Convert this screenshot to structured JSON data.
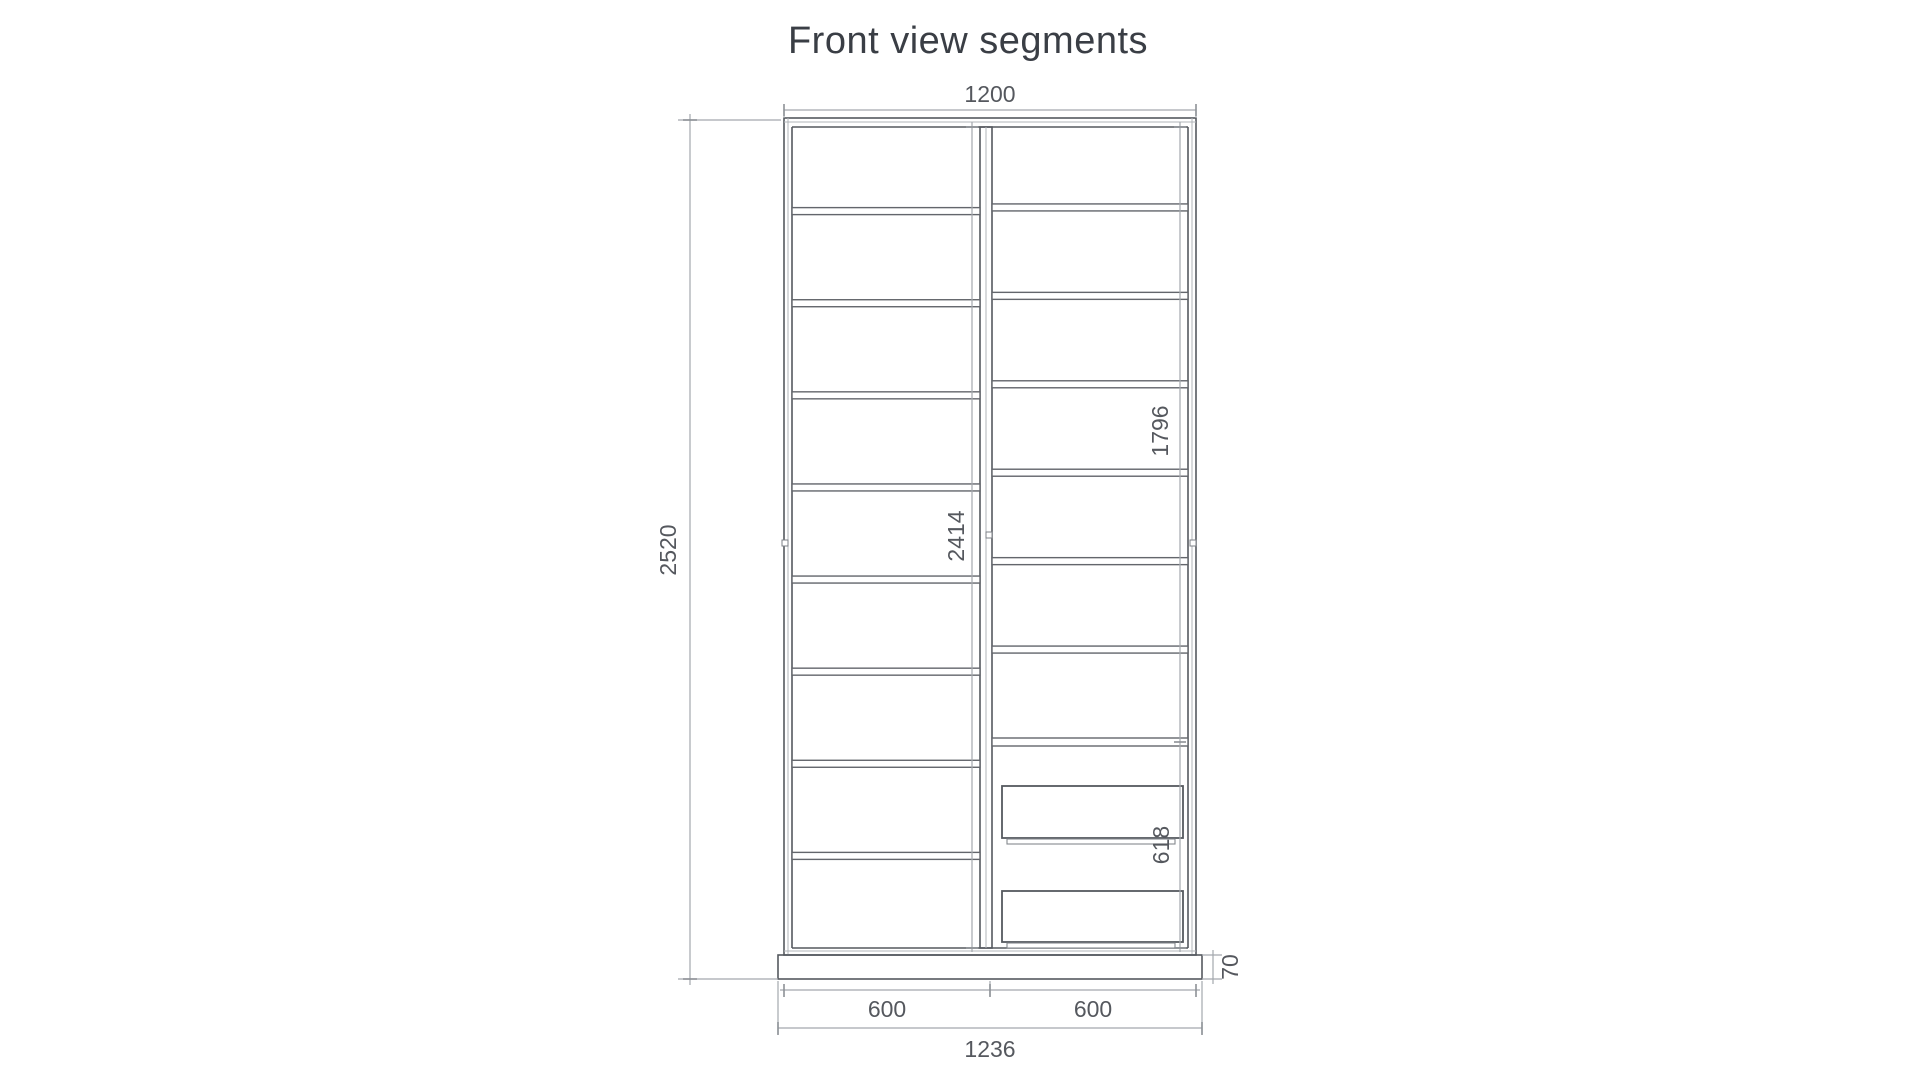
{
  "title": "Front view segments",
  "dimensions": {
    "top_width": "1200",
    "overall_height": "2520",
    "left_bay_inner_height": "2414",
    "right_upper_section_height": "1796",
    "drawer_section_height": "618",
    "plinth_height": "70",
    "left_bay_width": "600",
    "right_bay_width": "600",
    "base_width": "1236"
  },
  "structure": {
    "left_bay_segments": 9,
    "right_bay_segments": 7,
    "drawer_count": 2
  },
  "colors": {
    "edge": "#55595f",
    "dimension_line": "#a4a8ad",
    "dimension_text": "#55585e",
    "title_text": "#3a3e45",
    "background": "#ffffff"
  }
}
